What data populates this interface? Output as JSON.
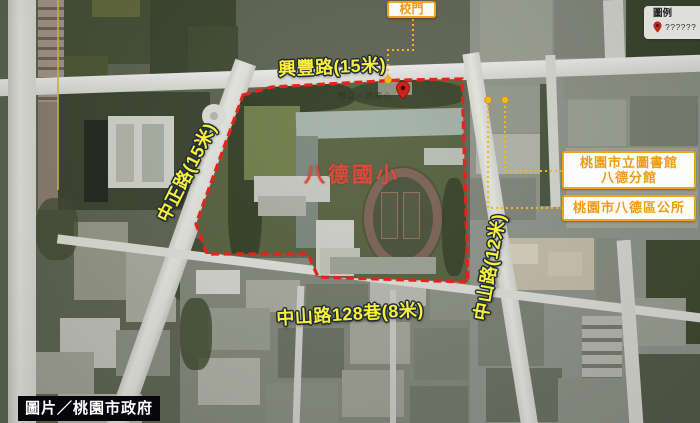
{
  "annotations": {
    "school_area_label": "八德國小",
    "basemap_label": "市立八德國小",
    "roads": [
      {
        "id": "xingfeng",
        "label": "興豐路(15米)"
      },
      {
        "id": "zhongzheng",
        "label": "中正路(15米)"
      },
      {
        "id": "zhongshan",
        "label": "中山路(12米)"
      },
      {
        "id": "zhongshan-lane-128",
        "label": "中山路128巷(8米)"
      }
    ],
    "callouts": [
      {
        "id": "school-gate",
        "label": "校門"
      },
      {
        "id": "library",
        "label": "桃園市立圖書館八德分館"
      },
      {
        "id": "district-office",
        "label": "桃園市八德區公所"
      }
    ]
  },
  "legend": {
    "title": "圖例",
    "items": [
      {
        "icon": "map-pin-icon",
        "label": "??????"
      }
    ]
  },
  "credit": {
    "text": "圖片／桃園市政府"
  },
  "colors": {
    "boundary_red": "#e8211a",
    "connector_yellow": "#f2b818",
    "road_label_yellow": "#f8ef38",
    "road_label_outline": "#1c2a3a",
    "school_name_red": "#df4a3c",
    "callout_orange": "#ee9c12",
    "callout_border": "#f0a31d",
    "legend_pin_red": "#cf2318",
    "credit_bg": "#06060b",
    "credit_text": "#ffffff"
  }
}
